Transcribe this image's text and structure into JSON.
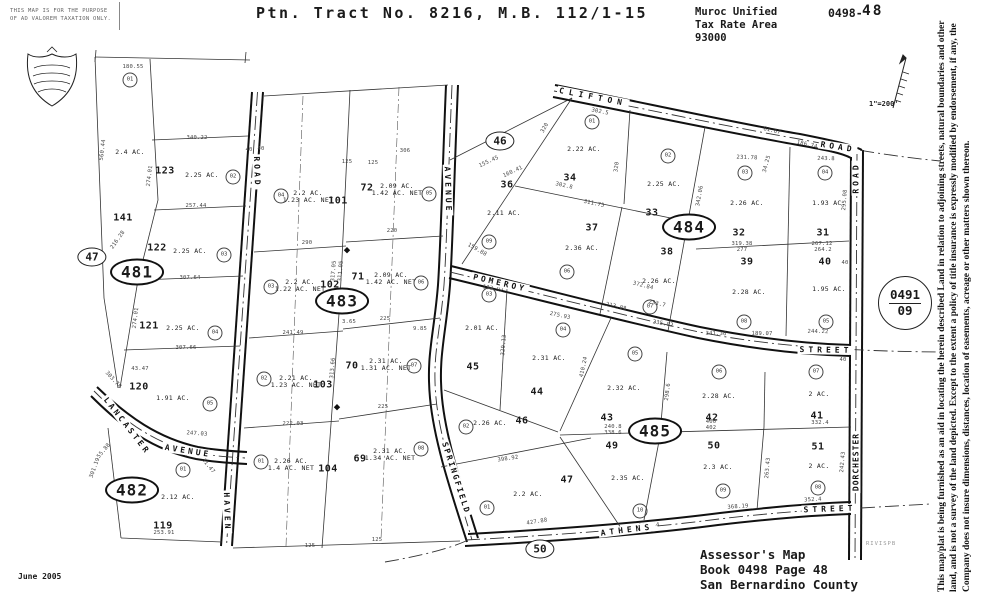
{
  "header": {
    "notice": "THIS MAP IS FOR THE PURPOSE OF AD VALOREM TAXATION ONLY.",
    "title": "Ptn. Tract No. 8216, M.B. 112/1-15",
    "tax_area": "Muroc Unified\nTax Rate Area\n93000",
    "page_code": "0498-",
    "page_num": "48"
  },
  "right_margin": {
    "disclaimer": "This map/plat is being furnished as an aid in locating the herein described Land in relation to adjoining streets, natural boundaries and other land, and is not a survey of the land depicted. Except to the extent a policy of title insurance is expressly modified by endorsement, if any, the Company does not insure dimensions, distances, location of easements, acreage or other matters shown thereon."
  },
  "footer": {
    "assessor": "Assessor's Map\nBook 0498 Page 48\nSan Bernardino County",
    "date": "June 2005",
    "stamp": "RIVISPB"
  },
  "map": {
    "scale_label": "1\"=200'",
    "ref_circle": {
      "book": "0491",
      "page": "09"
    },
    "blocks": [
      {
        "n": "481",
        "x": 137,
        "y": 272
      },
      {
        "n": "482",
        "x": 132,
        "y": 490
      },
      {
        "n": "483",
        "x": 342,
        "y": 301
      },
      {
        "n": "484",
        "x": 689,
        "y": 227
      },
      {
        "n": "485",
        "x": 655,
        "y": 431
      }
    ],
    "page_refs": [
      {
        "n": "47",
        "x": 92,
        "y": 257
      },
      {
        "n": "46",
        "x": 500,
        "y": 141
      },
      {
        "n": "50",
        "x": 540,
        "y": 549
      }
    ],
    "streets": [
      {
        "t": "CLIFTON",
        "x": 593,
        "y": 97,
        "r": 11,
        "ls": 5
      },
      {
        "t": "ROAD",
        "x": 838,
        "y": 147,
        "r": 9,
        "ls": 4
      },
      {
        "t": "POMEROY",
        "x": 500,
        "y": 283,
        "r": 13,
        "ls": 3
      },
      {
        "t": "STREET",
        "x": 826,
        "y": 350,
        "r": 1,
        "ls": 4
      },
      {
        "t": "ATHENS",
        "x": 627,
        "y": 530,
        "r": -7,
        "ls": 4
      },
      {
        "t": "STREET",
        "x": 830,
        "y": 509,
        "r": -2,
        "ls": 4
      },
      {
        "t": "LANCASTER",
        "x": 127,
        "y": 426,
        "r": 52,
        "ls": 3
      },
      {
        "t": "AVENUE",
        "x": 188,
        "y": 451,
        "r": 9,
        "ls": 3
      },
      {
        "t": "HAVEN",
        "x": 227,
        "y": 512,
        "r": 88,
        "ls": 3
      },
      {
        "t": "ROAD",
        "x": 257,
        "y": 172,
        "r": 88,
        "ls": 3
      },
      {
        "t": "SPRINGFIELD",
        "x": 456,
        "y": 478,
        "r": 72,
        "ls": 2
      },
      {
        "t": "AVENUE",
        "x": 448,
        "y": 190,
        "r": 88,
        "ls": 3
      },
      {
        "t": "DORCHESTER",
        "x": 856,
        "y": 462,
        "r": -90,
        "ls": 1
      },
      {
        "t": "ROAD",
        "x": 856,
        "y": 178,
        "r": -90,
        "ls": 3
      }
    ],
    "parcels": [
      {
        "n": "141",
        "nx": 123,
        "ny": 218,
        "ac": "2.4 AC.",
        "ax": 130,
        "ay": 152,
        "c": "01",
        "cx": 130,
        "cy": 80
      },
      {
        "n": "123",
        "nx": 165,
        "ny": 171,
        "ac": "2.25 AC.",
        "ax": 202,
        "ay": 175,
        "c": "02",
        "cx": 233,
        "cy": 177
      },
      {
        "n": "122",
        "nx": 157,
        "ny": 248,
        "ac": "2.25 AC.",
        "ax": 190,
        "ay": 251,
        "c": "03",
        "cx": 224,
        "cy": 255
      },
      {
        "n": "121",
        "nx": 149,
        "ny": 326,
        "ac": "2.25 AC.",
        "ax": 183,
        "ay": 328,
        "c": "04",
        "cx": 215,
        "cy": 333
      },
      {
        "n": "120",
        "nx": 139,
        "ny": 387,
        "ac": "1.91 AC.",
        "ax": 173,
        "ay": 398,
        "c": "05",
        "cx": 210,
        "cy": 404
      },
      {
        "n": "119",
        "nx": 163,
        "ny": 526,
        "ac": "2.12 AC.",
        "ax": 178,
        "ay": 497,
        "c": "01",
        "cx": 183,
        "cy": 470
      },
      {
        "n": "101",
        "nx": 338,
        "ny": 201,
        "ac": "2.2 AC.",
        "ax": 308,
        "ay": 193,
        "net": "1.23 AC. NET",
        "c": "04",
        "cx": 281,
        "cy": 196
      },
      {
        "n": "72",
        "nx": 367,
        "ny": 188,
        "ac": "2.09 AC.",
        "ax": 397,
        "ay": 186,
        "net": "1.42 AC. NET",
        "c": "05",
        "cx": 429,
        "cy": 194
      },
      {
        "n": "102",
        "nx": 330,
        "ny": 285,
        "ac": "2.2 AC.",
        "ax": 300,
        "ay": 282,
        "net": "1.22 AC. NET",
        "c": "03",
        "cx": 271,
        "cy": 287
      },
      {
        "n": "71",
        "nx": 358,
        "ny": 277,
        "ac": "2.09 AC.",
        "ax": 391,
        "ay": 275,
        "net": "1.42 AC. NET",
        "c": "06",
        "cx": 421,
        "cy": 283
      },
      {
        "n": "103",
        "nx": 323,
        "ny": 385,
        "ac": "2.21 AC.",
        "ax": 296,
        "ay": 378,
        "net": "1.23 AC. NET",
        "c": "02",
        "cx": 264,
        "cy": 379
      },
      {
        "n": "70",
        "nx": 352,
        "ny": 366,
        "ac": "2.31 AC.",
        "ax": 386,
        "ay": 361,
        "net": "1.31 AC. NET",
        "c": "07",
        "cx": 414,
        "cy": 366
      },
      {
        "n": "104",
        "nx": 328,
        "ny": 469,
        "ac": "2.26 AC.",
        "ax": 291,
        "ay": 461,
        "net": "1.4 AC. NET",
        "c": "01",
        "cx": 261,
        "cy": 462
      },
      {
        "n": "69",
        "nx": 360,
        "ny": 459,
        "ac": "2.31 AC.",
        "ax": 390,
        "ay": 451,
        "net": "1.34 AC. NET",
        "c": "08",
        "cx": 421,
        "cy": 449
      },
      {
        "n": "36",
        "nx": 507,
        "ny": 185,
        "ac": "2.11 AC.",
        "ax": 504,
        "ay": 213,
        "c": "09",
        "cx": 489,
        "cy": 242
      },
      {
        "n": "34",
        "nx": 570,
        "ny": 178,
        "ac": "2.22 AC.",
        "ax": 584,
        "ay": 149,
        "c": "01",
        "cx": 592,
        "cy": 122
      },
      {
        "n": "33",
        "nx": 652,
        "ny": 213,
        "ac": "2.25 AC.",
        "ax": 664,
        "ay": 184,
        "c": "02",
        "cx": 668,
        "cy": 156
      },
      {
        "n": "37",
        "nx": 592,
        "ny": 228,
        "ac": "2.36 AC.",
        "ax": 582,
        "ay": 248,
        "c": "06",
        "cx": 567,
        "cy": 272
      },
      {
        "n": "38",
        "nx": 667,
        "ny": 252,
        "ac": "2.26 AC.",
        "ax": 659,
        "ay": 281,
        "c": "07",
        "cx": 650,
        "cy": 307
      },
      {
        "n": "32",
        "nx": 739,
        "ny": 233,
        "ac": "2.26 AC.",
        "ax": 747,
        "ay": 203,
        "c": "03",
        "cx": 745,
        "cy": 173
      },
      {
        "n": "31",
        "nx": 823,
        "ny": 233,
        "ac": "1.93 AC.",
        "ax": 829,
        "ay": 203,
        "c": "04",
        "cx": 825,
        "cy": 173
      },
      {
        "n": "39",
        "nx": 747,
        "ny": 262,
        "ac": "2.28 AC.",
        "ax": 749,
        "ay": 292,
        "c": "08",
        "cx": 744,
        "cy": 322
      },
      {
        "n": "40",
        "nx": 825,
        "ny": 262,
        "ac": "1.95 AC.",
        "ax": 829,
        "ay": 289,
        "c": "05",
        "cx": 826,
        "cy": 322
      },
      {
        "n": "45",
        "nx": 473,
        "ny": 367,
        "ac": "2.01 AC.",
        "ax": 482,
        "ay": 328,
        "c": "03",
        "cx": 489,
        "cy": 295
      },
      {
        "n": "44",
        "nx": 537,
        "ny": 392,
        "ac": "2.31 AC.",
        "ax": 549,
        "ay": 358,
        "c": "04",
        "cx": 563,
        "cy": 330
      },
      {
        "n": "43",
        "nx": 607,
        "ny": 418,
        "ac": "2.32 AC.",
        "ax": 624,
        "ay": 388,
        "c": "05",
        "cx": 635,
        "cy": 354
      },
      {
        "n": "42",
        "nx": 712,
        "ny": 418,
        "ac": "2.28 AC.",
        "ax": 719,
        "ay": 396,
        "c": "06",
        "cx": 719,
        "cy": 372
      },
      {
        "n": "41",
        "nx": 817,
        "ny": 416,
        "ac": "2 AC.",
        "ax": 819,
        "ay": 394,
        "c": "07",
        "cx": 816,
        "cy": 372
      },
      {
        "n": "46",
        "nx": 522,
        "ny": 421,
        "ac": "2.26 AC.",
        "ax": 490,
        "ay": 423,
        "c": "02",
        "cx": 466,
        "cy": 427
      },
      {
        "n": "47",
        "nx": 567,
        "ny": 480,
        "ac": "2.2 AC.",
        "ax": 528,
        "ay": 494,
        "c": "01",
        "cx": 487,
        "cy": 508
      },
      {
        "n": "49",
        "nx": 612,
        "ny": 446,
        "ac": "2.35 AC.",
        "ax": 628,
        "ay": 478,
        "c": "10",
        "cx": 640,
        "cy": 511
      },
      {
        "n": "50",
        "nx": 714,
        "ny": 446,
        "ac": "2.3 AC.",
        "ax": 718,
        "ay": 467,
        "c": "09",
        "cx": 723,
        "cy": 491
      },
      {
        "n": "51",
        "nx": 818,
        "ny": 447,
        "ac": "2 AC.",
        "ax": 819,
        "ay": 466,
        "c": "08",
        "cx": 818,
        "cy": 488
      }
    ],
    "dims": [
      {
        "t": "560.44",
        "x": 103,
        "y": 150,
        "r": -83
      },
      {
        "t": "180.55",
        "x": 133,
        "y": 67
      },
      {
        "t": "340.22",
        "x": 197,
        "y": 138
      },
      {
        "t": "274.01",
        "x": 150,
        "y": 176,
        "r": -83
      },
      {
        "t": "257.44",
        "x": 196,
        "y": 206
      },
      {
        "t": "216.28",
        "x": 118,
        "y": 240,
        "r": -55
      },
      {
        "t": "307.64",
        "x": 190,
        "y": 278
      },
      {
        "t": "274.01",
        "x": 136,
        "y": 318,
        "r": -83
      },
      {
        "t": "307.66",
        "x": 186,
        "y": 348
      },
      {
        "t": "43.47",
        "x": 140,
        "y": 369
      },
      {
        "t": "303.78",
        "x": 113,
        "y": 380,
        "r": 48
      },
      {
        "t": "247.03",
        "x": 197,
        "y": 434,
        "r": 4
      },
      {
        "t": "147.53",
        "x": 196,
        "y": 455,
        "r": 4
      },
      {
        "t": "31.47",
        "x": 208,
        "y": 466,
        "r": 52
      },
      {
        "t": "301.19",
        "x": 95,
        "y": 468,
        "r": -70
      },
      {
        "t": "55.88",
        "x": 104,
        "y": 451,
        "r": -50
      },
      {
        "t": "253.91",
        "x": 164,
        "y": 533
      },
      {
        "t": "40",
        "x": 249,
        "y": 150
      },
      {
        "t": "40",
        "x": 261,
        "y": 149
      },
      {
        "t": "306",
        "x": 405,
        "y": 151
      },
      {
        "t": "125",
        "x": 347,
        "y": 162
      },
      {
        "t": "125",
        "x": 373,
        "y": 163
      },
      {
        "t": "290",
        "x": 307,
        "y": 243
      },
      {
        "t": "220",
        "x": 392,
        "y": 231
      },
      {
        "t": "317.05",
        "x": 334,
        "y": 271,
        "r": -85
      },
      {
        "t": "311.05",
        "x": 341,
        "y": 271,
        "r": -85
      },
      {
        "t": "241.49",
        "x": 293,
        "y": 333
      },
      {
        "t": "3.65",
        "x": 349,
        "y": 322
      },
      {
        "t": "225",
        "x": 385,
        "y": 319
      },
      {
        "t": "9.85",
        "x": 420,
        "y": 329
      },
      {
        "t": "313.66",
        "x": 333,
        "y": 368,
        "r": -85
      },
      {
        "t": "222.03",
        "x": 293,
        "y": 424
      },
      {
        "t": "225",
        "x": 383,
        "y": 407
      },
      {
        "t": "125",
        "x": 310,
        "y": 546
      },
      {
        "t": "125",
        "x": 377,
        "y": 540
      },
      {
        "t": "155.45",
        "x": 489,
        "y": 162,
        "r": -25
      },
      {
        "t": "160.41",
        "x": 513,
        "y": 172,
        "r": -25
      },
      {
        "t": "159.88",
        "x": 477,
        "y": 250,
        "r": 30
      },
      {
        "t": "302.5",
        "x": 600,
        "y": 112,
        "r": 11
      },
      {
        "t": "320",
        "x": 545,
        "y": 128,
        "r": -60
      },
      {
        "t": "81.67",
        "x": 772,
        "y": 131,
        "r": 13
      },
      {
        "t": "186.74",
        "x": 807,
        "y": 145,
        "r": 13
      },
      {
        "t": "231.78",
        "x": 747,
        "y": 158,
        "r": 2
      },
      {
        "t": "243.8",
        "x": 826,
        "y": 159,
        "r": 1
      },
      {
        "t": "34.25",
        "x": 767,
        "y": 164,
        "r": -75
      },
      {
        "t": "342.06",
        "x": 700,
        "y": 196,
        "r": -80
      },
      {
        "t": "295.08",
        "x": 845,
        "y": 200,
        "r": -85
      },
      {
        "t": "302.8",
        "x": 564,
        "y": 186,
        "r": 12
      },
      {
        "t": "311.75",
        "x": 594,
        "y": 204,
        "r": 12
      },
      {
        "t": "320",
        "x": 617,
        "y": 167,
        "r": -82
      },
      {
        "t": "319.38",
        "x": 742,
        "y": 244
      },
      {
        "t": "277",
        "x": 742,
        "y": 250
      },
      {
        "t": "267.12",
        "x": 822,
        "y": 244
      },
      {
        "t": "264.2",
        "x": 823,
        "y": 250
      },
      {
        "t": "141.5",
        "x": 497,
        "y": 281,
        "r": 10
      },
      {
        "t": "133.92",
        "x": 493,
        "y": 289,
        "r": 10
      },
      {
        "t": "372.84",
        "x": 643,
        "y": 286,
        "r": 14
      },
      {
        "t": "233.7",
        "x": 657,
        "y": 304,
        "r": 13
      },
      {
        "t": "275.93",
        "x": 560,
        "y": 316,
        "r": 12
      },
      {
        "t": "213.08",
        "x": 616,
        "y": 307,
        "r": 13
      },
      {
        "t": "235.02",
        "x": 663,
        "y": 324,
        "r": 10
      },
      {
        "t": "341.36",
        "x": 716,
        "y": 334,
        "r": 1
      },
      {
        "t": "189.07",
        "x": 762,
        "y": 334,
        "r": 1
      },
      {
        "t": "244.22",
        "x": 818,
        "y": 332,
        "r": 1
      },
      {
        "t": "40",
        "x": 845,
        "y": 263
      },
      {
        "t": "40",
        "x": 843,
        "y": 360
      },
      {
        "t": "329.13",
        "x": 504,
        "y": 345,
        "r": -85
      },
      {
        "t": "410.24",
        "x": 584,
        "y": 367,
        "r": -78
      },
      {
        "t": "298.6",
        "x": 668,
        "y": 392,
        "r": -83
      },
      {
        "t": "240.8",
        "x": 613,
        "y": 427
      },
      {
        "t": "338.6",
        "x": 613,
        "y": 433
      },
      {
        "t": "400",
        "x": 711,
        "y": 422
      },
      {
        "t": "402",
        "x": 711,
        "y": 428
      },
      {
        "t": "332.4",
        "x": 820,
        "y": 423
      },
      {
        "t": "263.43",
        "x": 768,
        "y": 468,
        "r": -85
      },
      {
        "t": "242.43",
        "x": 843,
        "y": 462,
        "r": -85
      },
      {
        "t": "398.92",
        "x": 508,
        "y": 459,
        "r": -8
      },
      {
        "t": "427.88",
        "x": 537,
        "y": 522,
        "r": -9
      },
      {
        "t": "239.44",
        "x": 649,
        "y": 526,
        "r": -5
      },
      {
        "t": "368.19",
        "x": 738,
        "y": 507,
        "r": -4
      },
      {
        "t": "352.4",
        "x": 813,
        "y": 500,
        "r": -3
      }
    ]
  }
}
